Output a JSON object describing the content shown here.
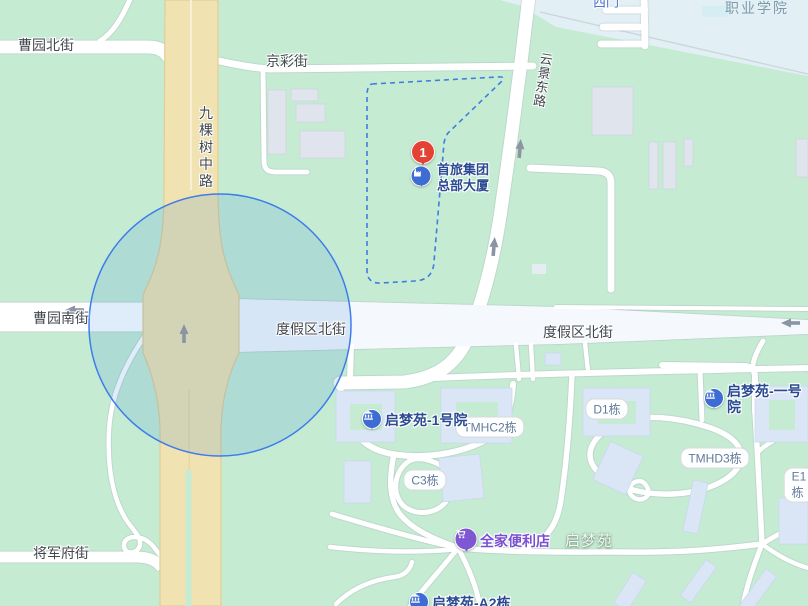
{
  "colors": {
    "map_background": "#c6ebd3",
    "campus_area": "#e2eff5",
    "main_road_yellow": "#f1e2b1",
    "road_white": "#ffffff",
    "radius_circle_stroke": "#3d7ceb",
    "plot_boundary_dash": "#3f7de0",
    "marker_red": "#e44234",
    "poi_blue": "#3d6cd3",
    "familymart_purple": "#7e57d2",
    "street_label": "#43474e",
    "poi_label_blue": "#2a4a92"
  },
  "streets": {
    "caoyuan_north": "曹园北街",
    "jingcai": "京彩街",
    "jiukeshu_middle": "九棵树中路",
    "yunjing_east": "云景东路",
    "caoyuan_south": "曹园南街",
    "dujiaqu_north_west": "度假区北街",
    "dujiaqu_north_east": "度假区北街",
    "jiangjunfu": "将军府街"
  },
  "places": {
    "west_gate": "西门",
    "vocational_college": "职业学院",
    "qimengyuan_area": "启梦苑"
  },
  "badges": {
    "tmhc2": "TMHC2栋",
    "d1": "D1栋",
    "tmhd3": "TMHD3栋",
    "c3": "C3栋",
    "e1": "E1栋"
  },
  "pois": {
    "hq": {
      "marker_number": "1",
      "line1": "首旅集团",
      "line2": "总部大厦"
    },
    "yard1_west": "启梦苑-1号院",
    "yard1_east": "启梦苑-一号院",
    "familymart": "全家便利店",
    "a2": "启梦苑-A2栋"
  }
}
